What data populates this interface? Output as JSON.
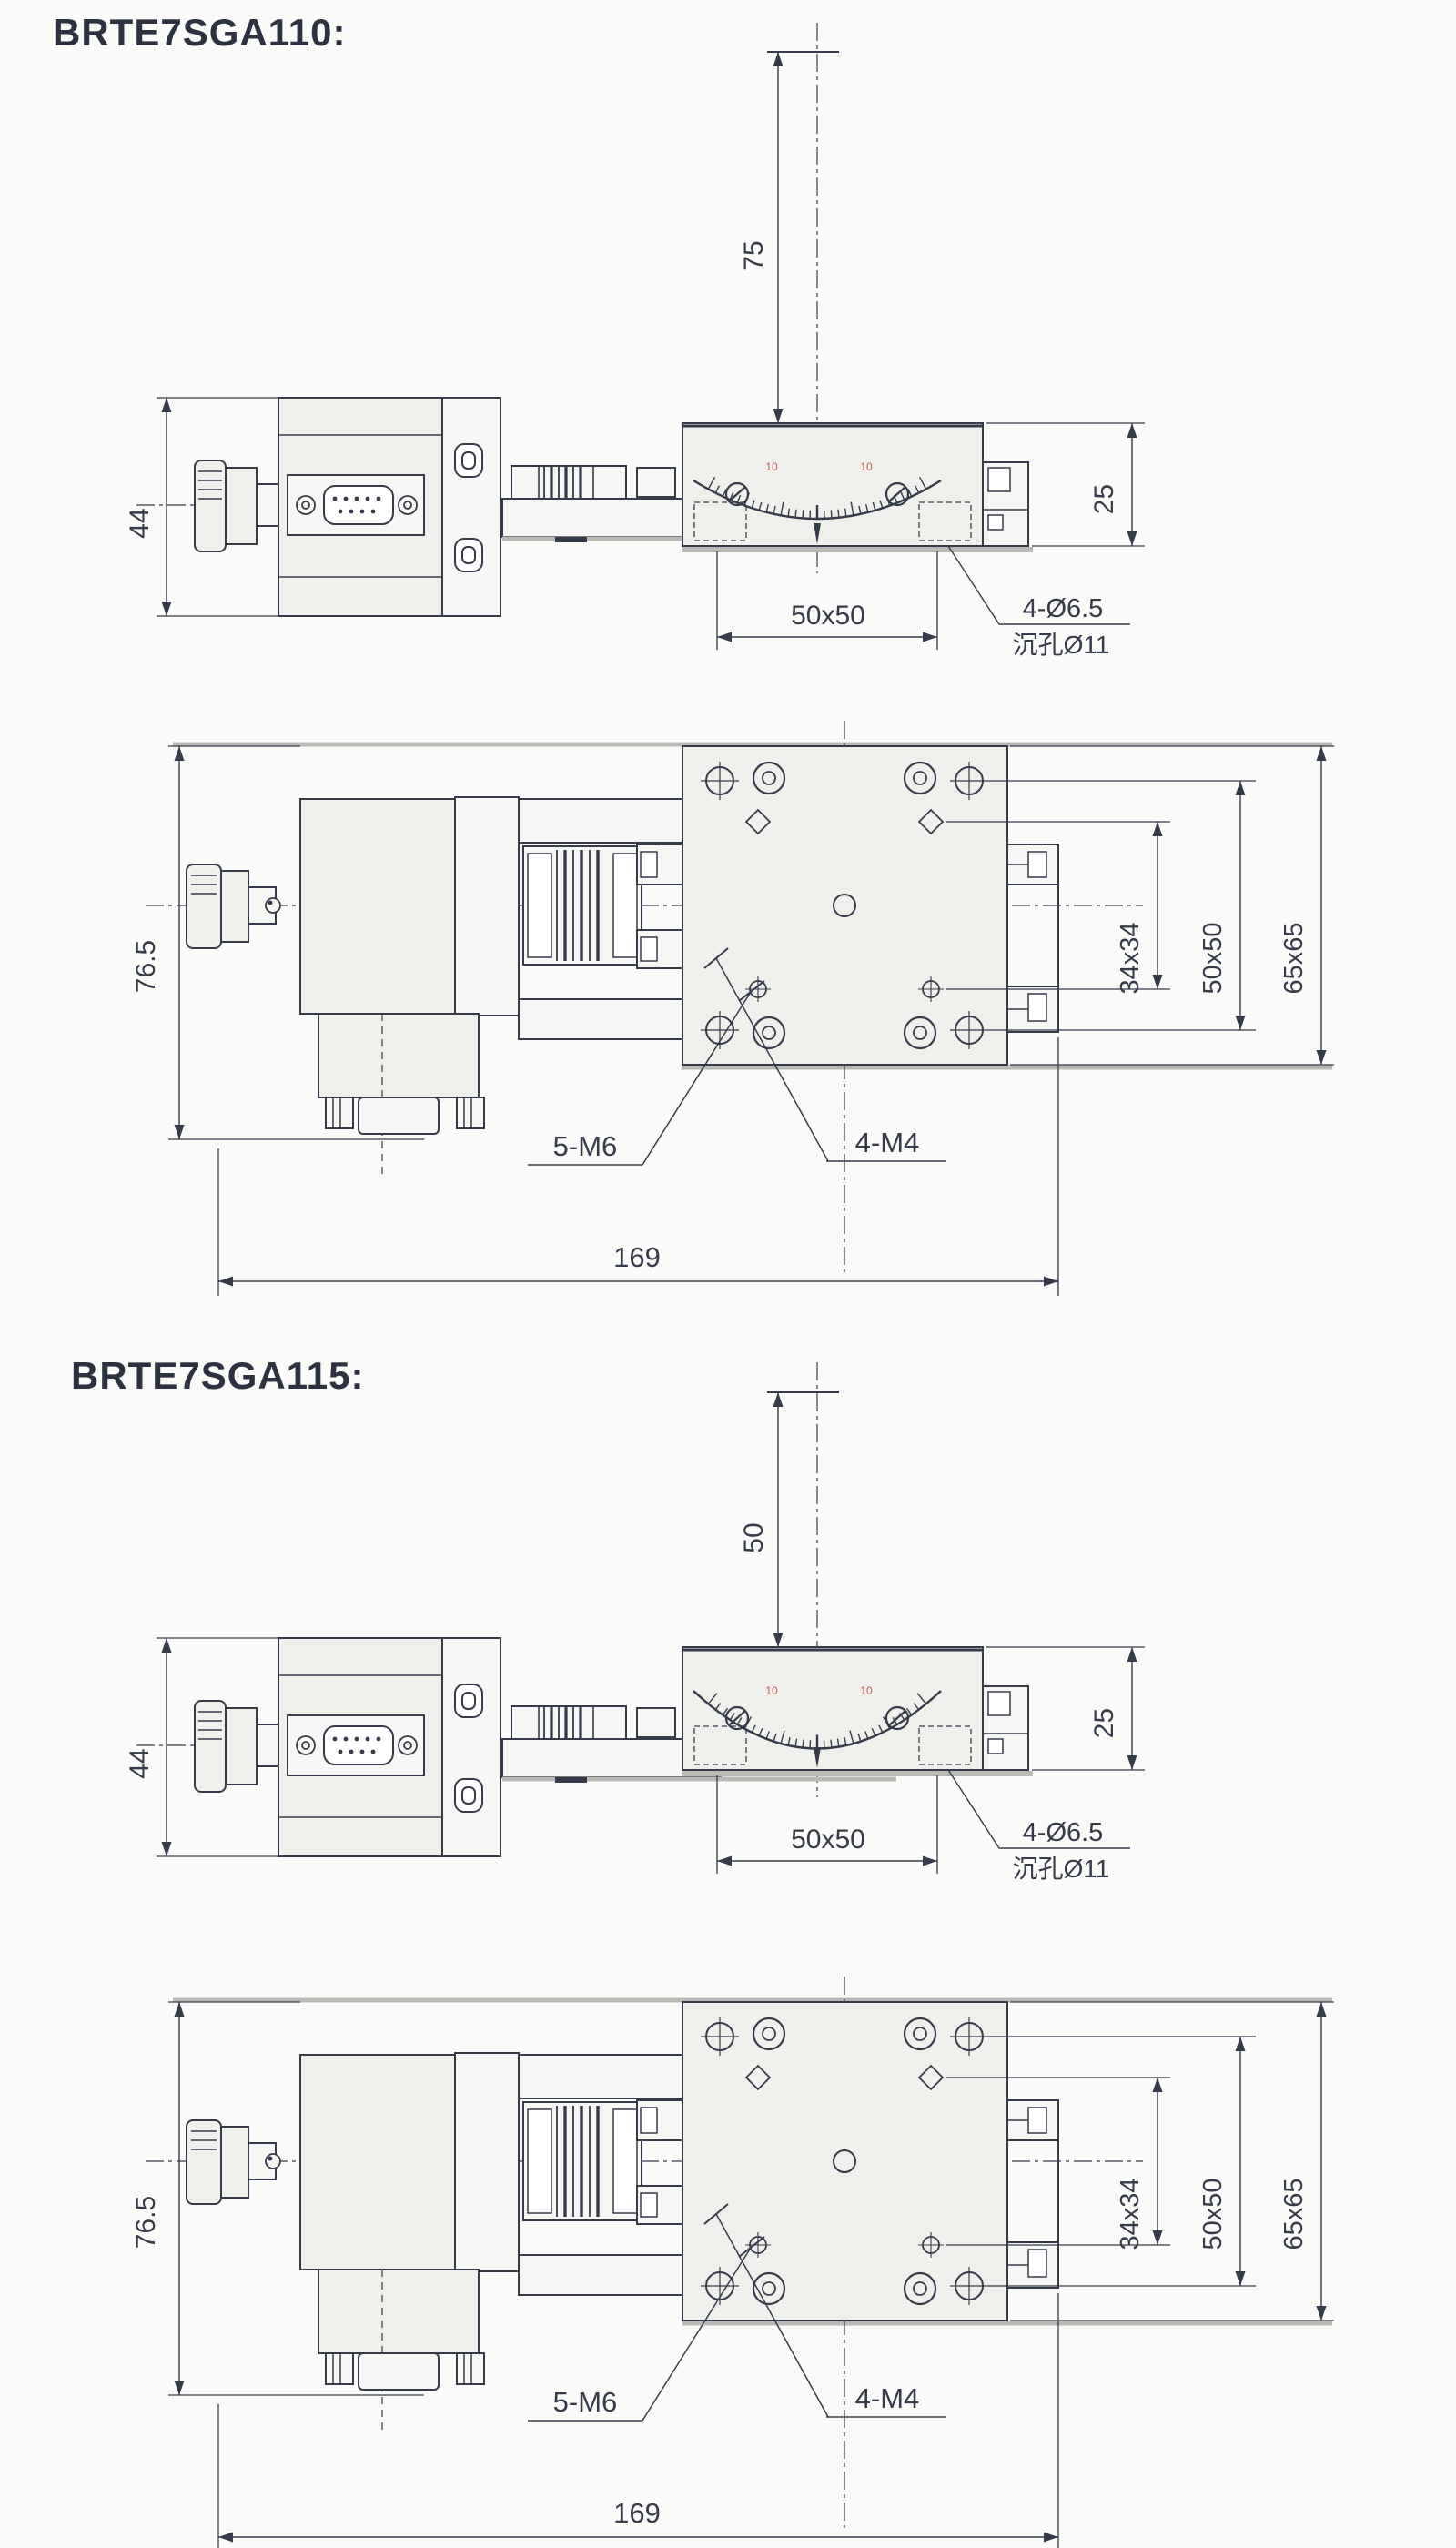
{
  "colors": {
    "ink": "#363b49",
    "fill": "#efefec",
    "fill_light": "#f6f6f4",
    "shadow": "#b9b9b5",
    "accent_red": "#b3493f",
    "background": "#fafaf8"
  },
  "models": [
    {
      "title": "BRTE7SGA110:",
      "side_view": {
        "center_height": "75",
        "body_height": "44",
        "stage_height": "25",
        "hole_span": "50x50",
        "hole_note_1": "4-Ø6.5",
        "hole_note_2": "沉孔Ø11",
        "scale_left": "10",
        "scale_right": "10"
      },
      "top_view": {
        "overall_width": "76.5",
        "pattern_inner": "34x34",
        "pattern_mid": "50x50",
        "platform_size": "65x65",
        "note_center": "5-M6",
        "note_corner": "4-M4",
        "overall_length": "169"
      }
    },
    {
      "title": "BRTE7SGA115:",
      "side_view": {
        "center_height": "50",
        "body_height": "44",
        "stage_height": "25",
        "hole_span": "50x50",
        "hole_note_1": "4-Ø6.5",
        "hole_note_2": "沉孔Ø11",
        "scale_left": "10",
        "scale_right": "10"
      },
      "top_view": {
        "overall_width": "76.5",
        "pattern_inner": "34x34",
        "pattern_mid": "50x50",
        "platform_size": "65x65",
        "note_center": "5-M6",
        "note_corner": "4-M4",
        "overall_length": "169"
      }
    }
  ]
}
